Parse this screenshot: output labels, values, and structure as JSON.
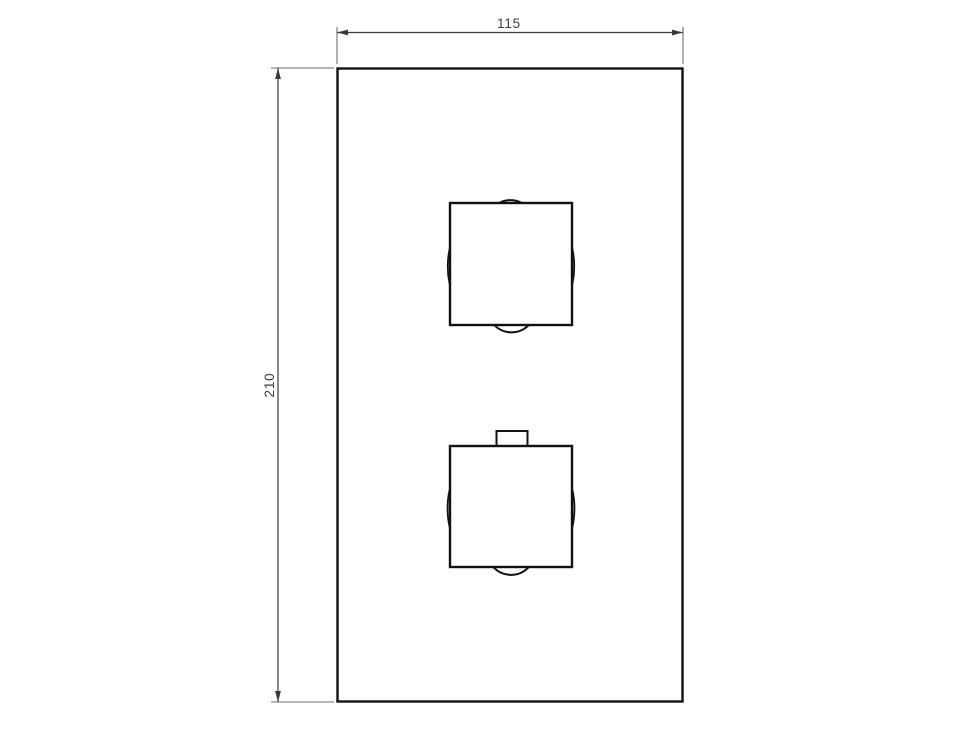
{
  "drawing": {
    "background": "#ffffff",
    "line_color": "#111111",
    "dimension_line_color": "#3a3a3a",
    "extension_line_color": "#6f6f6f",
    "text_color": "#3d3d3d",
    "dimensions": {
      "width": "115",
      "height": "210"
    }
  }
}
